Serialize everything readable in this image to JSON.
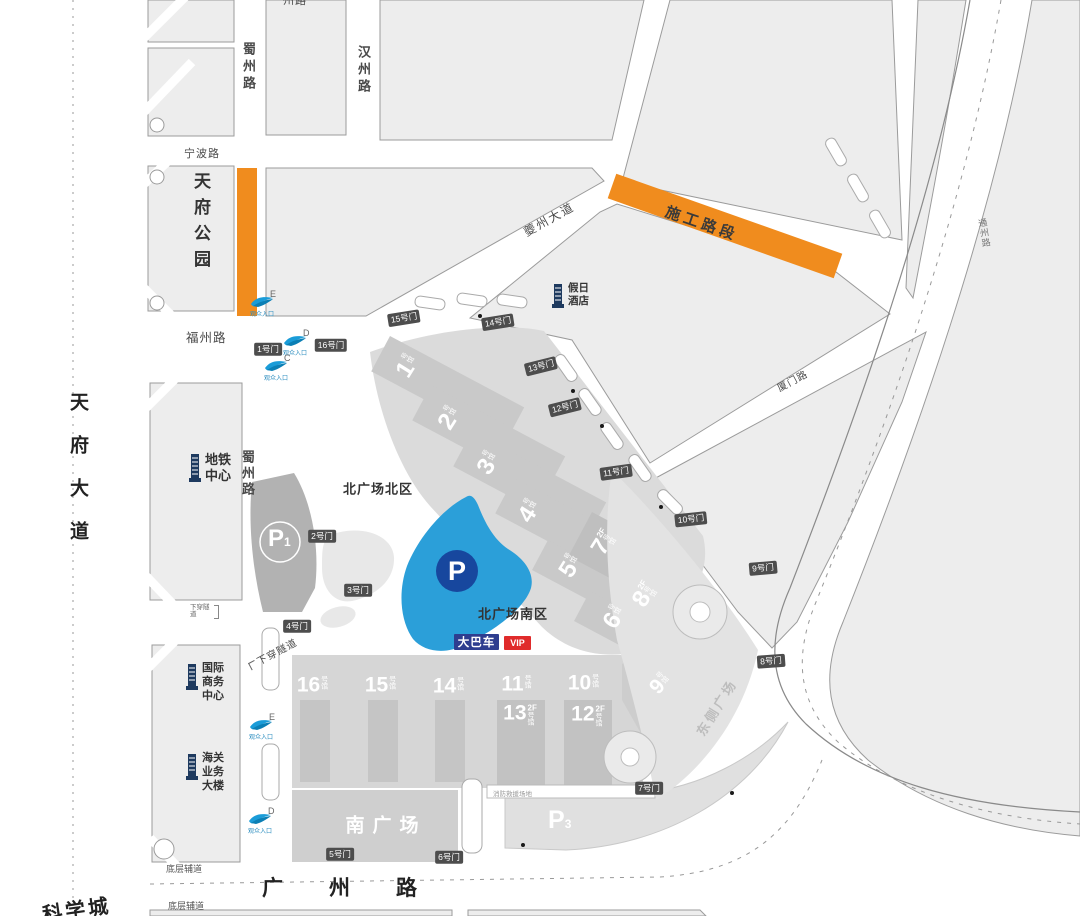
{
  "roads": {
    "tianfu_avenue": "天府大道",
    "kexuecheng": "科学城",
    "shuzhou_top": "蜀州路",
    "shuzhou_mid": "蜀州路",
    "hanzhou": "汉州路",
    "ningbo": "宁波路",
    "fuzhou": "福州路",
    "kuizhou": "夔州大道",
    "guangzhou": "广州路",
    "xiamen": "厦门路",
    "tongzhou": "通州路",
    "tunnel": "下穿隧道",
    "tunnel_small": "下穿隧道",
    "service_road_upper": "底层辅道",
    "service_road_lower": "底层辅道",
    "top_clipped": "州路"
  },
  "places": {
    "tianfu_park": "天府公园",
    "metro_center": "地铁中心",
    "intl_business": "国际商务中心",
    "customs": "海关业务大楼",
    "holiday_hotel": "假日酒店",
    "north_plaza_north": "北广场北区",
    "north_plaza_south": "北广场南区",
    "south_plaza": "南广场",
    "east_plaza": "东侧广场",
    "construction_zone": "施工路段",
    "fire_note": "消防救援场地"
  },
  "parking": {
    "p1_letter": "P",
    "p1_sub": "1",
    "p3_letter": "P",
    "p3_sub": "3",
    "main_letter": "P"
  },
  "badges": {
    "bus": "大巴车",
    "vip": "VIP"
  },
  "halls": {
    "north": [
      {
        "num": "1",
        "suffix": "号馆",
        "floor": ""
      },
      {
        "num": "2",
        "suffix": "号馆",
        "floor": ""
      },
      {
        "num": "3",
        "suffix": "号馆",
        "floor": ""
      },
      {
        "num": "4",
        "suffix": "号馆",
        "floor": ""
      },
      {
        "num": "5",
        "suffix": "号馆",
        "floor": ""
      },
      {
        "num": "6",
        "suffix": "号馆",
        "floor": ""
      },
      {
        "num": "7",
        "suffix": "号馆",
        "floor": "2F"
      },
      {
        "num": "8",
        "suffix": "号馆",
        "floor": "2F"
      }
    ],
    "south": [
      {
        "num": "16",
        "suffix": "号馆",
        "floor": ""
      },
      {
        "num": "15",
        "suffix": "号馆",
        "floor": ""
      },
      {
        "num": "14",
        "suffix": "号馆",
        "floor": ""
      },
      {
        "num": "11",
        "suffix": "号馆",
        "floor": ""
      },
      {
        "num": "10",
        "suffix": "号馆",
        "floor": ""
      },
      {
        "num": "13",
        "suffix": "号馆",
        "floor": "2F"
      },
      {
        "num": "12",
        "suffix": "号馆",
        "floor": "2F"
      },
      {
        "num": "9",
        "suffix": "号馆",
        "floor": ""
      }
    ]
  },
  "gates": [
    "1号门",
    "2号门",
    "3号门",
    "4号门",
    "5号门",
    "6号门",
    "7号门",
    "8号门",
    "9号门",
    "10号门",
    "11号门",
    "12号门",
    "13号门",
    "14号门",
    "15号门",
    "16号门"
  ],
  "entrances": [
    {
      "letter": "E",
      "caption": "观众入口"
    },
    {
      "letter": "D",
      "caption": "观众入口"
    },
    {
      "letter": "C",
      "caption": "观众入口"
    },
    {
      "letter": "E",
      "caption": "观众入口"
    },
    {
      "letter": "D",
      "caption": "观众入口"
    }
  ],
  "colors": {
    "construction": "#F08C1E",
    "parking_blue": "#2B9FD9",
    "parking_circle": "#17479E",
    "bus_badge": "#2E3D8F",
    "vip_badge": "#E02B2B",
    "building_icon": "#1E3A5F",
    "entrance_blue": "#1A9CD8"
  }
}
